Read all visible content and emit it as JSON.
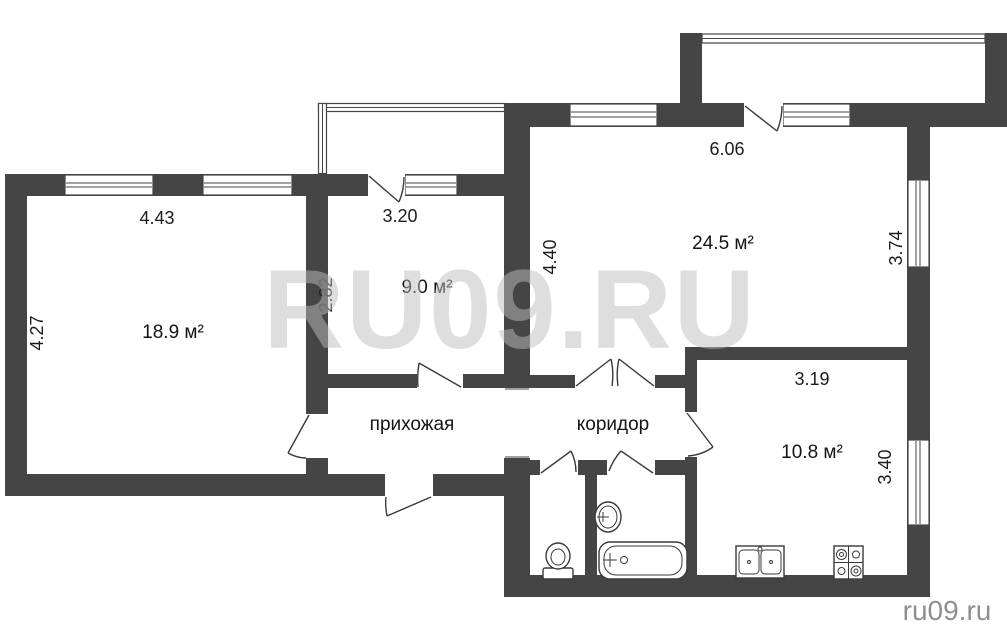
{
  "rooms": {
    "living": {
      "area_label": "18.9 м²"
    },
    "bedroom": {
      "area_label": "9.0 м²"
    },
    "hall": {
      "area_label": "24.5 м²"
    },
    "kitchen": {
      "area_label": "10.8 м²"
    },
    "entry": {
      "name_label": "прихожая"
    },
    "corridor": {
      "name_label": "коридор"
    }
  },
  "dimensions": {
    "living_width": "4.43",
    "living_depth": "4.27",
    "bedroom_width": "3.20",
    "bedroom_depth": "2.82",
    "hall_width": "6.06",
    "hall_depth_left": "4.40",
    "hall_depth_right": "3.74",
    "kitchen_width": "3.19",
    "kitchen_depth": "3.40"
  },
  "watermark": {
    "text": "RU09.RU"
  },
  "footer": {
    "site_label": "ru09.ru"
  },
  "fixtures": [
    "toilet-icon",
    "washbasin-icon",
    "bathtub-icon",
    "kitchen-sink-icon",
    "stove-icon"
  ],
  "colors": {
    "wall": "#454545",
    "fixture_line": "#3a3a3a",
    "label_text": "#141414",
    "watermark": "#bdbdbd",
    "site_text": "#8f8f8f",
    "background": "#ffffff"
  }
}
